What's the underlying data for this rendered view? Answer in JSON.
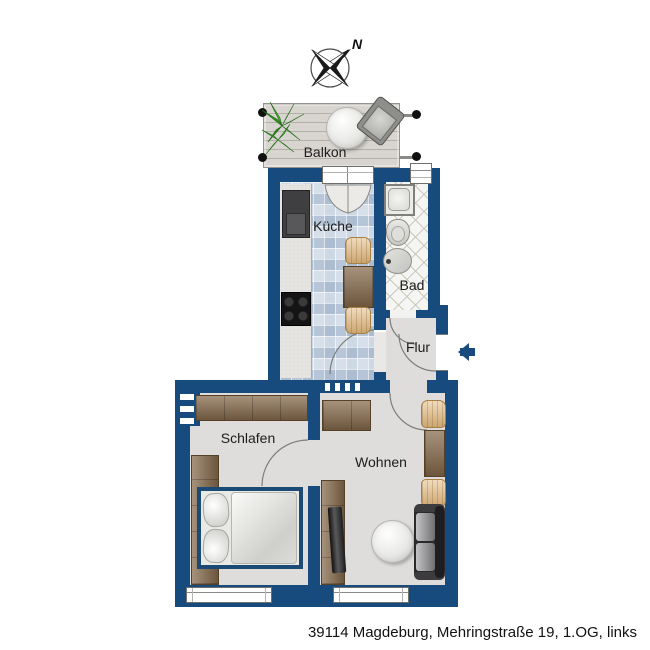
{
  "compass": {
    "north_label": "N"
  },
  "labels": {
    "balkon": "Balkon",
    "kueche": "Küche",
    "bad": "Bad",
    "flur": "Flur",
    "schlafen": "Schlafen",
    "wohnen": "Wohnen"
  },
  "footer": {
    "address": "39114 Magdeburg, Mehringstraße 19, 1.OG, links"
  },
  "colors": {
    "wall": "#174b7d",
    "floor": "#dedddb",
    "kitchen_tile": "#c7d3e1",
    "wood": "#84684a",
    "chair": "#e7c494",
    "entrance_arrow": "#174b7d",
    "background": "#ffffff"
  },
  "symbols": [
    "compass-rose-icon",
    "entrance-arrow-icon",
    "balcony-plant",
    "round-table",
    "balcony-chair",
    "kitchen-counter",
    "fridge",
    "stove",
    "kitchen-table",
    "chair",
    "shower",
    "toilet",
    "sink",
    "wardrobe",
    "side-cabinet",
    "double-bed",
    "pillow",
    "sideboard",
    "tv-board",
    "tv",
    "dining-table",
    "round-rug",
    "sofa",
    "window",
    "door-swing"
  ]
}
